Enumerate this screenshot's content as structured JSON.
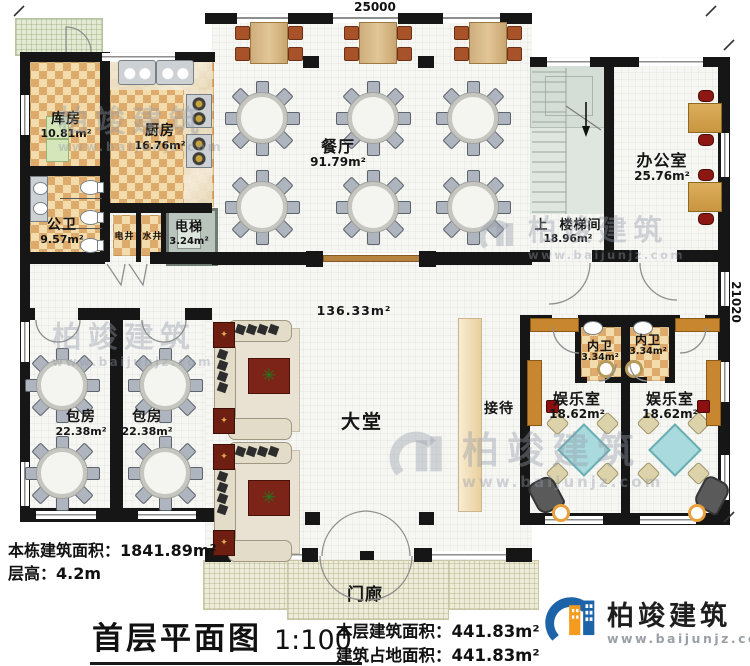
{
  "dimensions": {
    "top_width": "25000",
    "right_height": "21020"
  },
  "rooms": {
    "storage": {
      "name": "库房",
      "area": "10.81m²"
    },
    "kitchen": {
      "name": "厨房",
      "area": "16.76m²"
    },
    "public_wc": {
      "name": "公卫",
      "area": "9.57m²"
    },
    "electric_shaft": {
      "name": "电井"
    },
    "water_shaft": {
      "name": "水井"
    },
    "elevator": {
      "name": "电梯",
      "area": "3.24m²"
    },
    "dining_hall": {
      "name": "餐厅",
      "area": "91.79m²"
    },
    "stairwell": {
      "name": "楼梯间",
      "area": "18.96m²",
      "up": "上"
    },
    "office": {
      "name": "办公室",
      "area": "25.76m²"
    },
    "lobby": {
      "name": "大堂",
      "area": "136.33m²"
    },
    "reception": {
      "name": "接待"
    },
    "private_room_1": {
      "name": "包房",
      "area": "22.38m²"
    },
    "private_room_2": {
      "name": "包房",
      "area": "22.38m²"
    },
    "ensuite_wc_1": {
      "name": "内卫",
      "area": "3.34m²"
    },
    "ensuite_wc_2": {
      "name": "内卫",
      "area": "3.34m²"
    },
    "game_room_1": {
      "name": "娱乐室",
      "area": "18.62m²"
    },
    "game_room_2": {
      "name": "娱乐室",
      "area": "18.62m²"
    },
    "porch": {
      "name": "门廊"
    }
  },
  "footer": {
    "building_total_label": "本栋建筑面积：",
    "building_total_value": "1841.89m²",
    "floor_height_label": "层高：",
    "floor_height_value": "4.2m",
    "title": "首层平面图",
    "scale": "1:100",
    "floor_area_label": "本层建筑面积：",
    "floor_area_value": "441.83m²",
    "footprint_label": "建筑占地面积：",
    "footprint_value": "441.83m²"
  },
  "brand": {
    "name": "柏竣建筑",
    "website": "www.baijunjz.com"
  },
  "watermark": {
    "name": "柏竣建筑",
    "website": "www.baijunjz.com"
  },
  "colors": {
    "wall": "#161616",
    "checker_light": "#f2dcab",
    "checker_dark": "#dfab6c",
    "brand_blue": "#1c63a8",
    "brand_orange": "#f59b20",
    "mahjong_teal": "#a9dadd"
  }
}
